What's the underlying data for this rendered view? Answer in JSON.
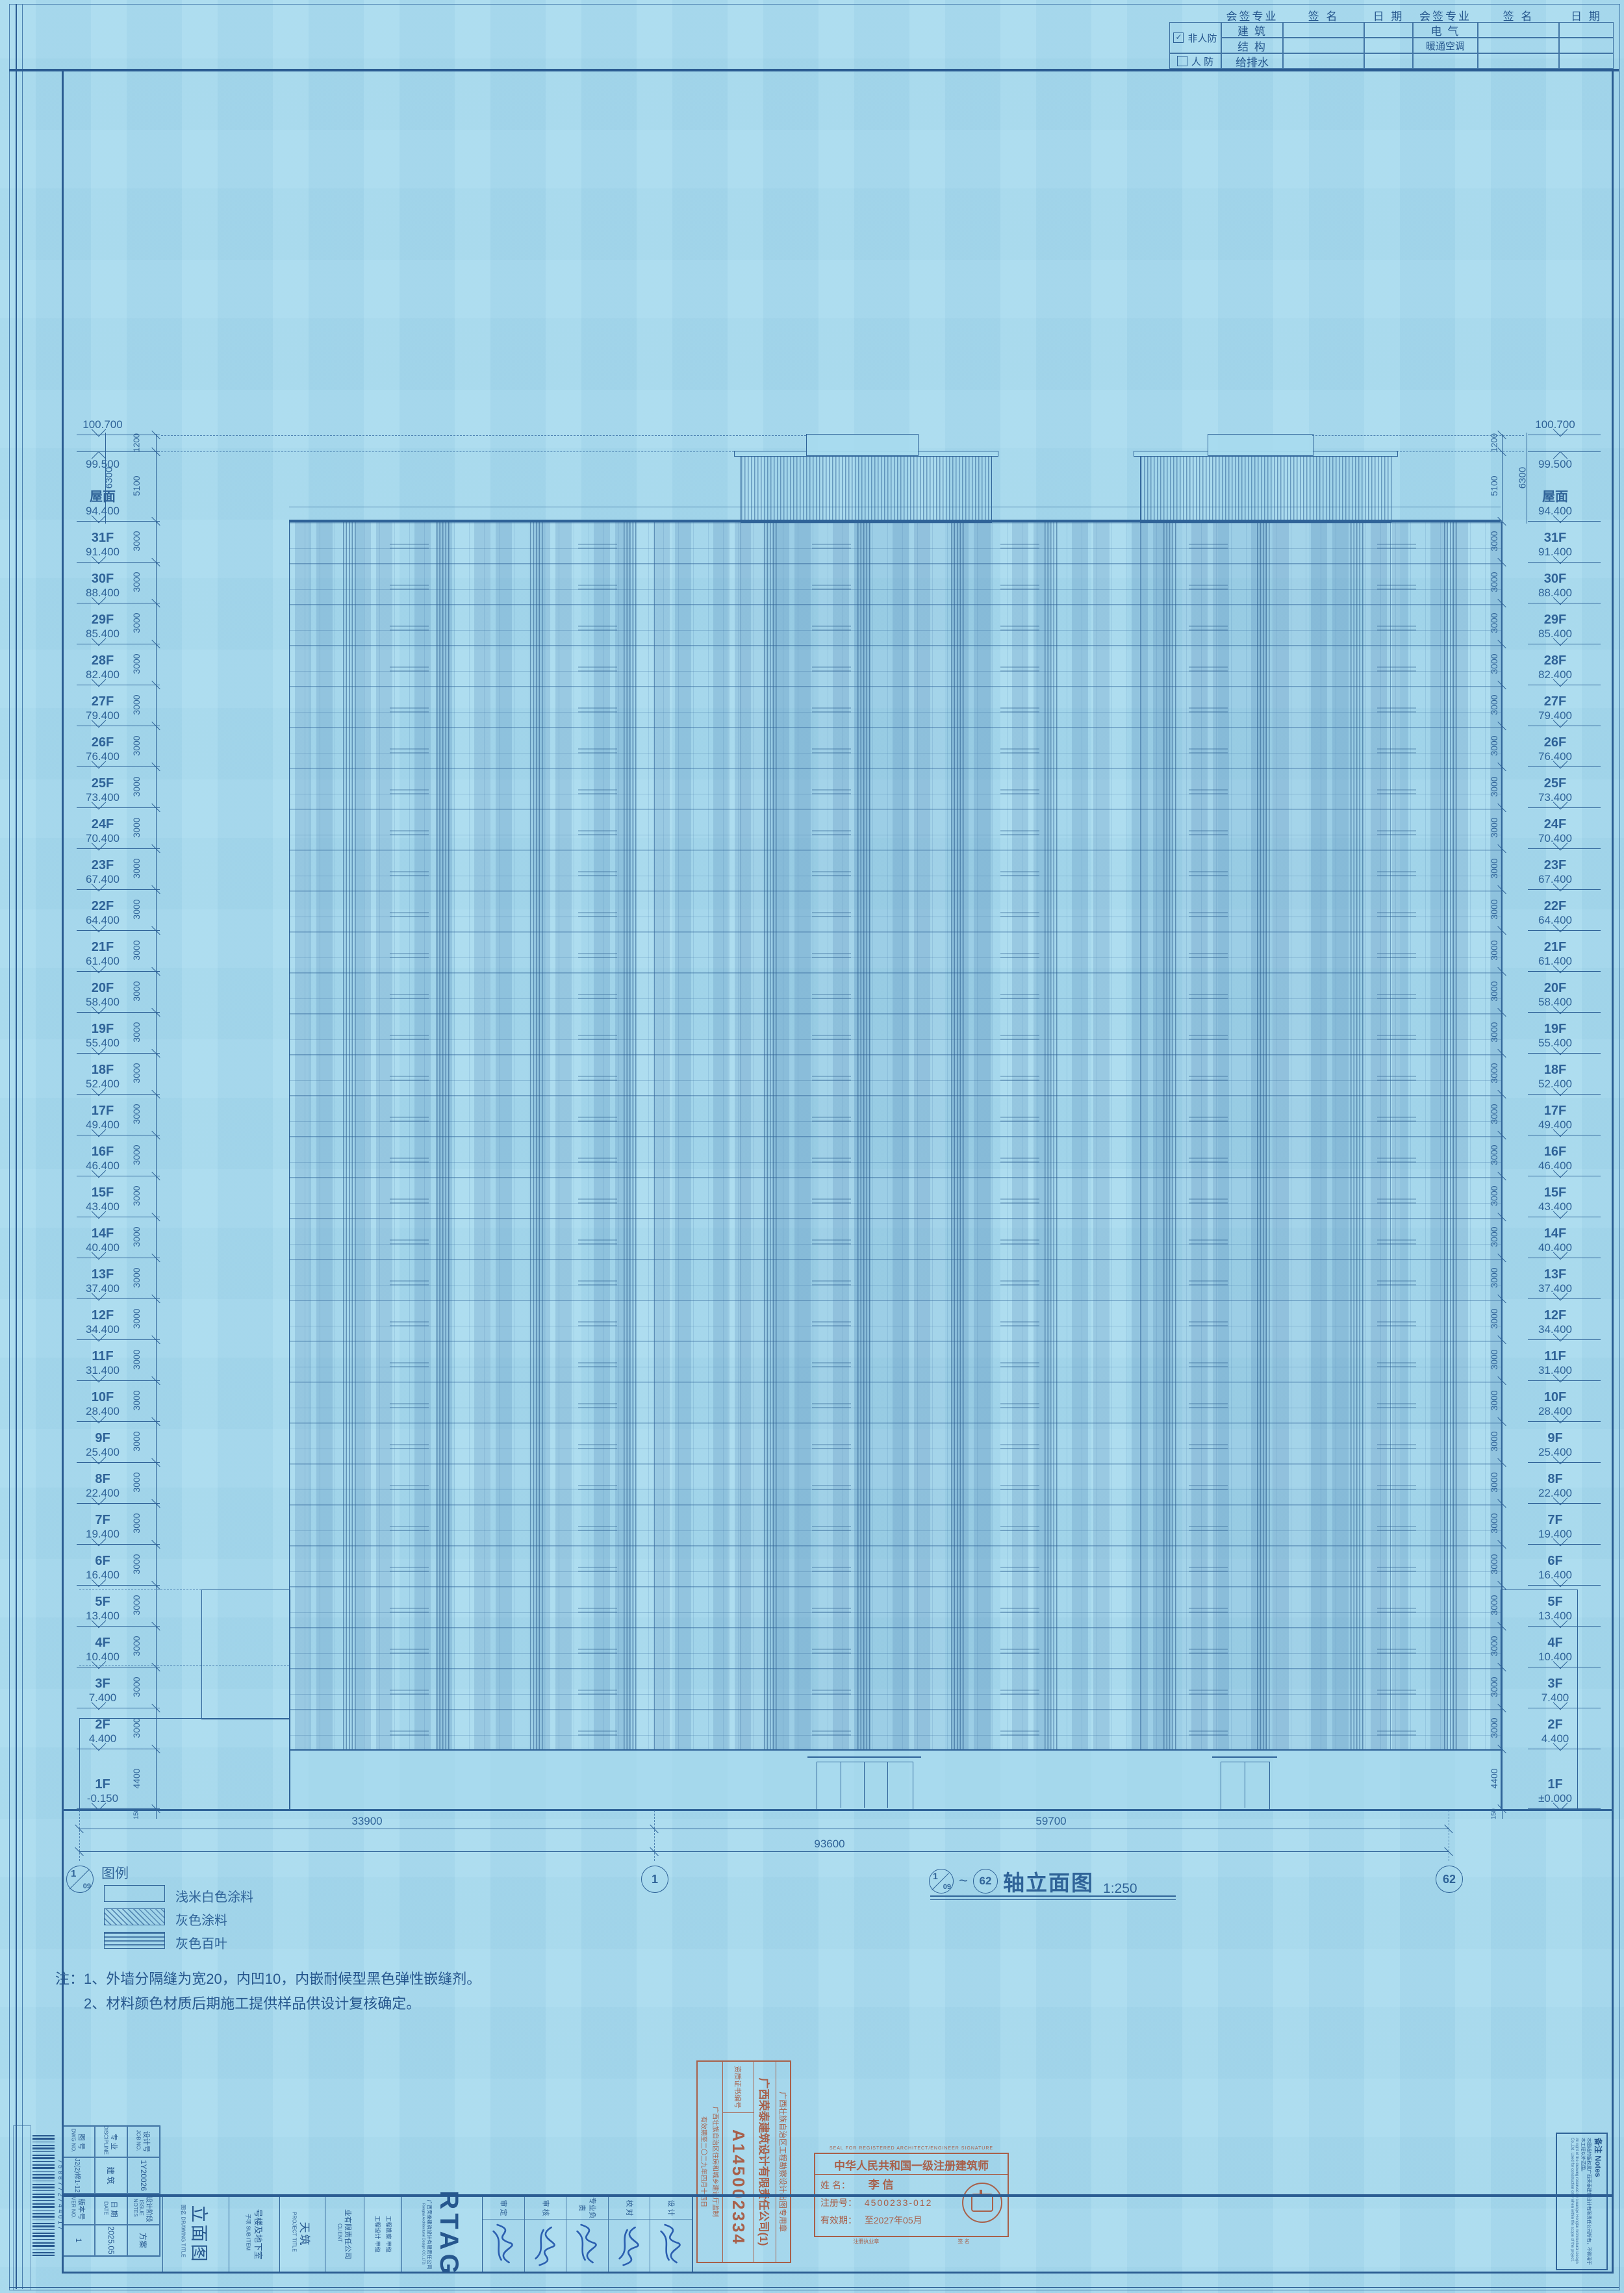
{
  "page": {
    "paper": "#a7daee",
    "ink": "#2f6398",
    "stamp_color": "#a8604a",
    "signature_color": "#2b5fb0"
  },
  "signoff": {
    "headers": [
      "会签专业",
      "签  名",
      "日  期",
      "会签专业",
      "签  名",
      "日  期"
    ],
    "stub": {
      "checked_label": "非人防",
      "unchecked_label": "人 防"
    },
    "rows": [
      [
        "建  筑",
        "电  气"
      ],
      [
        "结  构",
        "暖通空调"
      ],
      [
        "给排水",
        ""
      ]
    ]
  },
  "levels": {
    "top": [
      {
        "elev": "100.700",
        "value": 100.7,
        "dir": "down"
      },
      {
        "elev": "99.500",
        "value": 99.5,
        "dir": "up"
      }
    ],
    "roof": {
      "label": "屋面",
      "elev": "94.400",
      "value": 94.4
    },
    "floors": [
      {
        "label": "31F",
        "elev": "91.400"
      },
      {
        "label": "30F",
        "elev": "88.400"
      },
      {
        "label": "29F",
        "elev": "85.400"
      },
      {
        "label": "28F",
        "elev": "82.400"
      },
      {
        "label": "27F",
        "elev": "79.400"
      },
      {
        "label": "26F",
        "elev": "76.400"
      },
      {
        "label": "25F",
        "elev": "73.400"
      },
      {
        "label": "24F",
        "elev": "70.400"
      },
      {
        "label": "23F",
        "elev": "67.400"
      },
      {
        "label": "22F",
        "elev": "64.400"
      },
      {
        "label": "21F",
        "elev": "61.400"
      },
      {
        "label": "20F",
        "elev": "58.400"
      },
      {
        "label": "19F",
        "elev": "55.400"
      },
      {
        "label": "18F",
        "elev": "52.400"
      },
      {
        "label": "17F",
        "elev": "49.400"
      },
      {
        "label": "16F",
        "elev": "46.400"
      },
      {
        "label": "15F",
        "elev": "43.400"
      },
      {
        "label": "14F",
        "elev": "40.400"
      },
      {
        "label": "13F",
        "elev": "37.400"
      },
      {
        "label": "12F",
        "elev": "34.400"
      },
      {
        "label": "11F",
        "elev": "31.400"
      },
      {
        "label": "10F",
        "elev": "28.400"
      },
      {
        "label": "9F",
        "elev": "25.400"
      },
      {
        "label": "8F",
        "elev": "22.400"
      },
      {
        "label": "7F",
        "elev": "19.400"
      },
      {
        "label": "6F",
        "elev": "16.400"
      },
      {
        "label": "5F",
        "elev": "13.400"
      },
      {
        "label": "4F",
        "elev": "10.400"
      },
      {
        "label": "3F",
        "elev": "7.400"
      },
      {
        "label": "2F",
        "elev": "4.400"
      }
    ],
    "first": {
      "label": "1F",
      "left_elev": "-0.150",
      "right_elev": "±0.000"
    }
  },
  "vdims": {
    "top": [
      "1200",
      "5100"
    ],
    "bracket": "6300",
    "typical": "3000",
    "bottom": [
      "4400",
      "150"
    ]
  },
  "hdims": {
    "segments": [
      {
        "label": "33900"
      },
      {
        "label": "59700"
      }
    ],
    "total": "93600"
  },
  "grids": [
    {
      "a": "1",
      "b": "09"
    },
    {
      "label": "1"
    },
    {
      "label": "62"
    }
  ],
  "title": {
    "from_a": "1",
    "from_b": "09",
    "to": "62",
    "text": "轴立面图",
    "scale": "1:250"
  },
  "legend": {
    "heading": "图例",
    "items": [
      {
        "name": "浅米白色涂料",
        "pattern": "plain"
      },
      {
        "name": "灰色涂料",
        "pattern": "diagonal"
      },
      {
        "name": "灰色百叶",
        "pattern": "louver"
      }
    ]
  },
  "notes": {
    "prefix": "注：",
    "lines": [
      "1、外墙分隔缝为宽20，内凹10，内嵌耐候型黑色弹性嵌缝剂。",
      "2、材料颜色材质后期施工提供样品供设计复核确定。"
    ]
  },
  "stamp_company": {
    "header": "广西壮族自治区工程勘察设计出图专用章",
    "company": "广西荣泰建筑设计有限责任公司(1)",
    "cert_label": "资质证书编号",
    "cert_no": "A145002334",
    "issuer": "广西壮族自治区住房和城乡建设厅监制",
    "valid": "有效期至二〇二九年四月十四日"
  },
  "stamp_architect": {
    "top": "SEAL FOR REGISTERED ARCHITECT/ENGINEER SIGNATURE",
    "title": "中华人民共和国一级注册建筑师",
    "name_label": "姓  名：",
    "name": "李  信",
    "reg_label": "注册号：",
    "reg_no": "4500233-012",
    "valid_label": "有效期：",
    "valid": "至2027年05月",
    "bottom_left": "注册执业章",
    "bottom_right": "签 名"
  },
  "corner_table": {
    "cells": [
      {
        "l": "设计号",
        "en": "JOB NO.",
        "v": "1Y20026"
      },
      {
        "l": "设计阶段",
        "en": "ISSUE NOTES",
        "v": "方案"
      },
      {
        "l": "专 业",
        "en": "DISCIPLINE",
        "v": "建 筑"
      },
      {
        "l": "日 期",
        "en": "DATE",
        "v": "2025.05"
      },
      {
        "l": "图 号",
        "en": "DWG NO.",
        "v": "J2(2)修1-12"
      },
      {
        "l": "版本号",
        "en": "VER NO.",
        "v": "1"
      }
    ],
    "barcode": "7588772744017"
  },
  "titleblock": {
    "drawing_name": "立面图",
    "drawing_label": "图名 DRAWING TITLE",
    "sub_item": "号楼及地下室",
    "sub_label": "子项 SUB ITEM",
    "project": "天筑",
    "project_label": "PROJECT TITLE",
    "client": "业有限责任公司",
    "client_label": "CLIENT",
    "certs": [
      "工程勘察 甲级",
      "工程设计 甲级"
    ],
    "logo": "RTAG",
    "company_cn": "广西荣泰建筑设计有限责任公司",
    "company_en": "Rongtai Architectural Design CO.,LTD.",
    "sign_roles": [
      "审 定",
      "审 核",
      "专业负责",
      "校 对",
      "设 计"
    ]
  },
  "remark": {
    "heading": "备注 Notes",
    "cn": "本图纸的版权属广西荣泰建筑设计有限责任公司所有，不得用于本工程以外范围。",
    "en": "All right of the drawing reserved by Guangxi Rongtai Architectural Design Co.,Ltd. Used for construction only when within the scope of the project."
  }
}
